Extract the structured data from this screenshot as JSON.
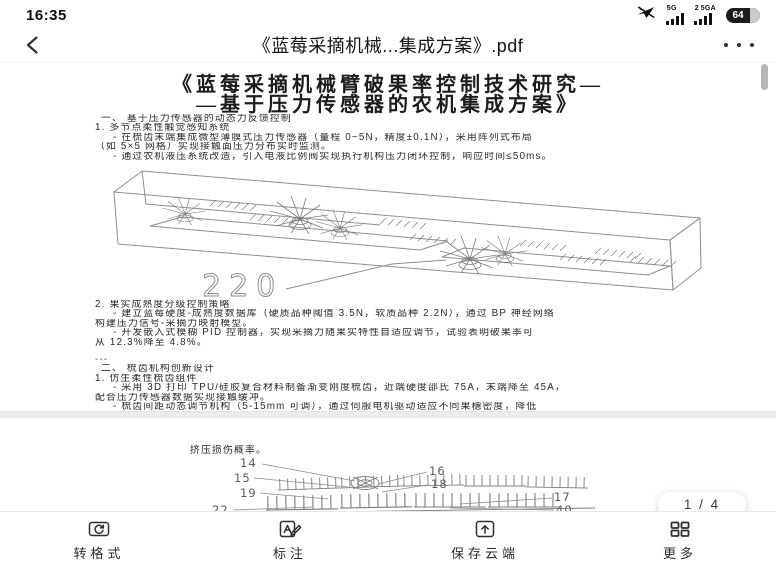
{
  "status_bar": {
    "time": "16:35",
    "sim1_network": "5G",
    "sim2_prefix": "2",
    "sim2_network": "5GA",
    "battery_level": "64"
  },
  "nav_bar": {
    "title": "《蓝莓采摘机械...集成方案》.pdf"
  },
  "document": {
    "page1": {
      "title_line1": "《蓝莓采摘机械臂破果率控制技术研究—",
      "title_line2": "—基于压力传感器的农机集成方案》",
      "lines_top": [
        "一、 基于压力传感器的动态力反馈控制",
        "1. 多节点柔性触觉感知系统",
        "- 在梳齿末端集成微型薄膜式压力传感器（量程 0~5N，精度±0.1N），采用阵列式布局",
        "（如 5×5 网格）实现接触面压力分布实时监测。",
        "- 通过农机液压系统改造，引入电液比例阀实现执行机构压力闭环控制，响应时间≤50ms。"
      ],
      "figure1": {
        "dimension_label": "220"
      },
      "lines_bottom": [
        "2. 果实成熟度分级控制策略",
        "- 建立蓝莓硬度-成熟度数据库（硬质品种阈值 3.5N，软质品种 2.2N），通过 BP 神经网络",
        "构建压力信号-采摘力映射模型。",
        "- 开发嵌入式模糊 PID 控制器，实现采摘力随果实特性自适应调节，试验表明破果率可",
        "从 12.3%降至 4.8%。",
        "---",
        "二、 梳齿机构创新设计",
        "1. 仿生柔性梳齿组件",
        "- 采用 3D 打印 TPU/硅胶复合材料制备渐变刚度梳齿，近端硬度邵氏 75A，末端降至 45A，",
        "配合压力传感器数据实现接触缓冲。",
        "- 梳齿间距动态调节机构（5-15mm 可调），通过伺服电机驱动适应不同果穗密度，降低"
      ]
    },
    "page2": {
      "lead_text": "挤压损伤概率。",
      "figure2": {
        "callouts": [
          "14",
          "15",
          "19",
          "22",
          "16",
          "18",
          "17",
          "40"
        ]
      }
    }
  },
  "page_indicator": "1 / 4",
  "toolbar": {
    "items": [
      {
        "label": "转格式"
      },
      {
        "label": "标注"
      },
      {
        "label": "保存云端"
      },
      {
        "label": "更多"
      }
    ]
  },
  "colors": {
    "status_icon": "#101010",
    "drawing_stroke": "#8f8f8f",
    "separator": "#ececec"
  }
}
